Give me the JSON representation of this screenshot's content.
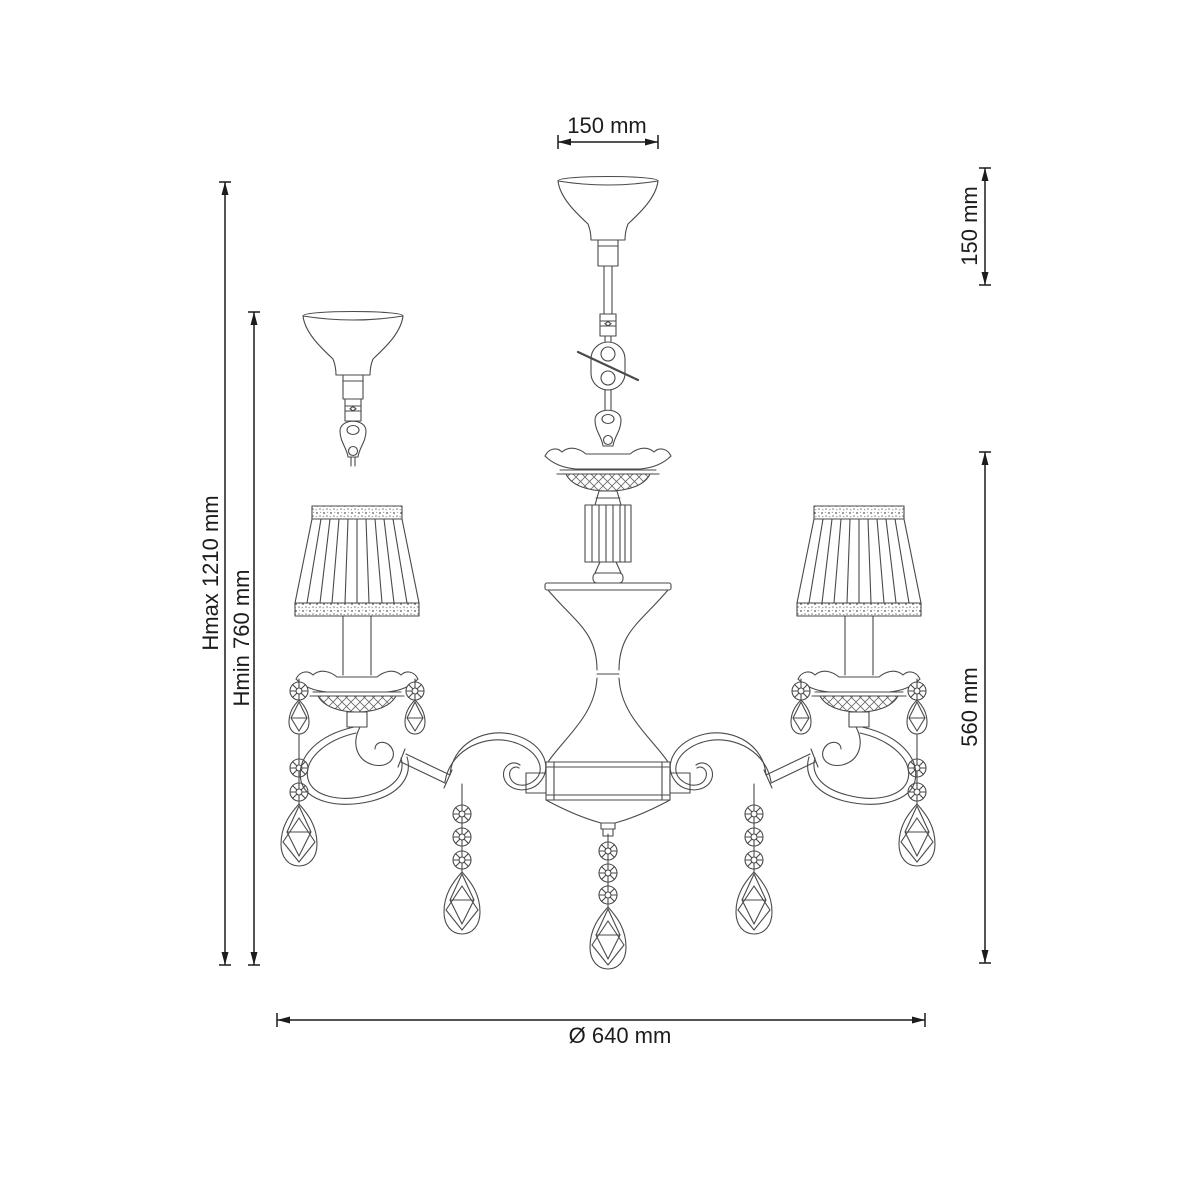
{
  "diagram": {
    "subject": "chandelier-technical-drawing",
    "stroke_color": "#4a4a4a",
    "dimension_color": "#1c1c1c",
    "background": "#ffffff",
    "dimensions": {
      "canopy_width": "150 mm",
      "suspension_height": "150 mm",
      "height_max": "Hmax 1210 mm",
      "height_min": "Hmin 760 mm",
      "body_height": "560 mm",
      "diameter": "Ø 640 mm"
    }
  }
}
